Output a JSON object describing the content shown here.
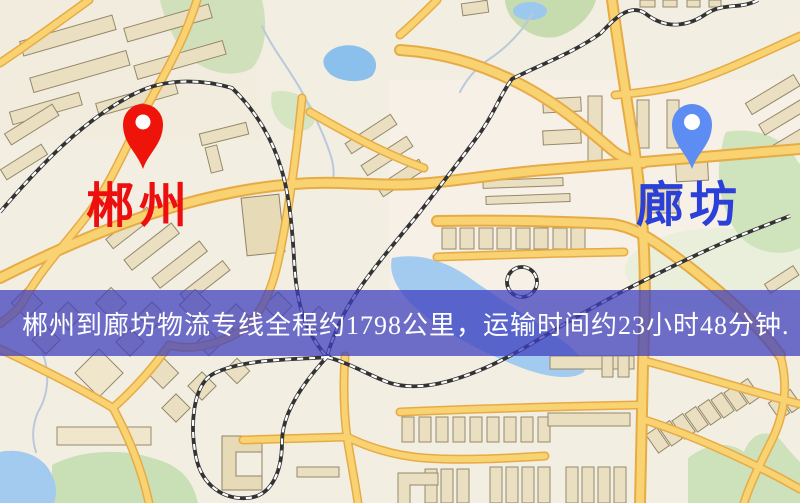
{
  "banner": {
    "text": "郴州到廊坊物流专线全程约1798公里，运输时间约23小时48分钟.",
    "distance_text": "约1798公里",
    "duration_text": "约23小时48分钟",
    "background_color": "#3e40be",
    "text_color": "#ffffff"
  },
  "markers": {
    "origin": {
      "label": "郴州",
      "pin_color": "#ee1409",
      "label_color": "#ed0f0f"
    },
    "destination": {
      "label": "廊坊",
      "pin_color": "#5d8cf2",
      "label_color": "#2b3fd9"
    }
  },
  "map_colors": {
    "background": "#f3eee2",
    "road_fill": "#f9d272",
    "road_casing": "#e7ab45",
    "water": "#a3cbf0",
    "park": "#cfe0ba",
    "building": "#eadfc0",
    "railway": "#333333"
  }
}
